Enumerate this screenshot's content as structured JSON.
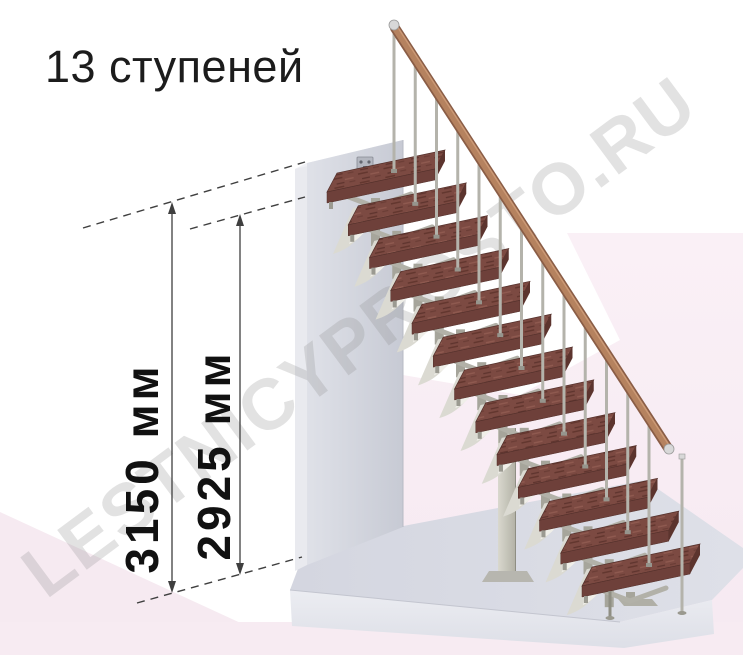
{
  "title": "13 ступеней",
  "watermark": "LESTNICYPROSTO.RU",
  "dimensions": {
    "total_height": {
      "label": "3150 мм",
      "value": 3150,
      "unit": "мм"
    },
    "step_level_height": {
      "label": "2925 мм",
      "value": 2925,
      "unit": "мм"
    }
  },
  "staircase": {
    "steps_count": 13
  },
  "colors": {
    "tread_top": "#7c4a42",
    "tread_streak_dark": "#5e342e",
    "tread_streak_light": "#8f5a50",
    "tread_front": "#6e403a",
    "tread_end": "#5c342e",
    "tread_outline": "#53302b",
    "rail_dark": "#8a5d46",
    "rail_main": "#b5825f",
    "rail_cap": "#d8d8d8",
    "baluster": "#b4b3ab",
    "metal_post": "#a6a59b",
    "metal_arm": "#b2b1a8",
    "metal_sail": "#dbdad2",
    "metal_sail_light": "#f0efe9",
    "metal_dark": "#8f8e83",
    "column_light": "#d9d8ce",
    "column_dark": "#b2b1a5",
    "wall_light": "#dfe1e8",
    "wall_dark": "#c7cad4",
    "wall_side": "#e9eaef",
    "wall_top": "#f0f1f5",
    "floor_top_light": "#dcdee7",
    "floor_top_dark": "#d2d4de",
    "floor_front": "#e7e8ee",
    "pink_light": "#faf0f6",
    "pink_deep": "#f6e9f1",
    "dimension_line": "#3f3f3f",
    "label_text": "#111111",
    "title_text": "#1c1c1c",
    "watermark_gray": "#8a8a8a"
  }
}
